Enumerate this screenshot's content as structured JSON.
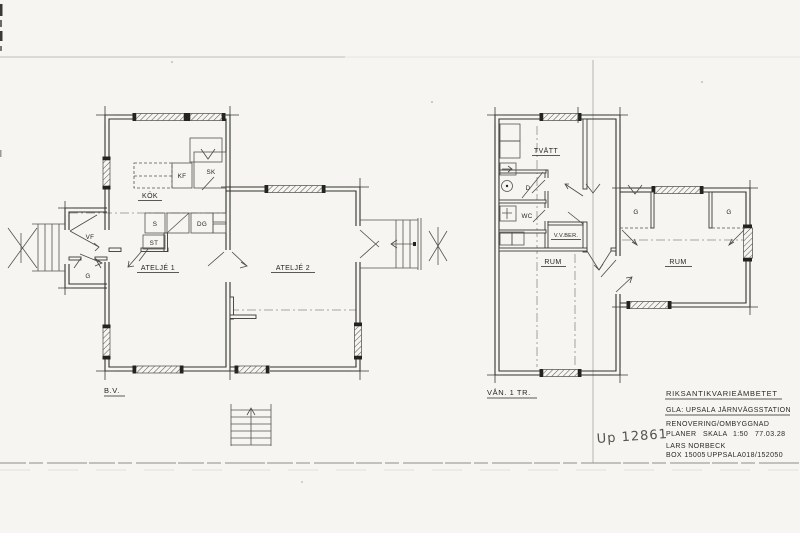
{
  "title_block": {
    "agency": "RIKSANTIKVARIEÄMBETET",
    "project": "GLA: UPSALA JÄRNVÄGSSTATION",
    "work": "RENOVERING/OMBYGGNAD",
    "drawing_type": "PLANER",
    "scale_label": "SKALA",
    "scale_value": "1:50",
    "date": "77.03.28",
    "architect": "LARS NORBECK",
    "address_box": "BOX 15005",
    "address_city": "UPPSALA",
    "address_phone": "018/152050"
  },
  "stamp": {
    "number": "Up 12861"
  },
  "plans": {
    "ground_floor": {
      "caption": "B.V.",
      "labels": {
        "atelje_1": "ATELJÉ 1",
        "atelje_2": "ATELJÉ 2",
        "kok": "KÖK",
        "vf": "VF",
        "g": "G",
        "s": "S",
        "st": "ST",
        "dg": "DG",
        "kf": "KF",
        "sk": "SK"
      }
    },
    "upper_floor": {
      "caption": "VÅN. 1 TR.",
      "labels": {
        "tvatt": "TVÄTT",
        "d": "D",
        "wc": "WC",
        "vvber": "V.V.BER.",
        "rum_left": "RUM",
        "rum_right": "RUM",
        "g_left": "G",
        "g_right": "G"
      }
    }
  }
}
